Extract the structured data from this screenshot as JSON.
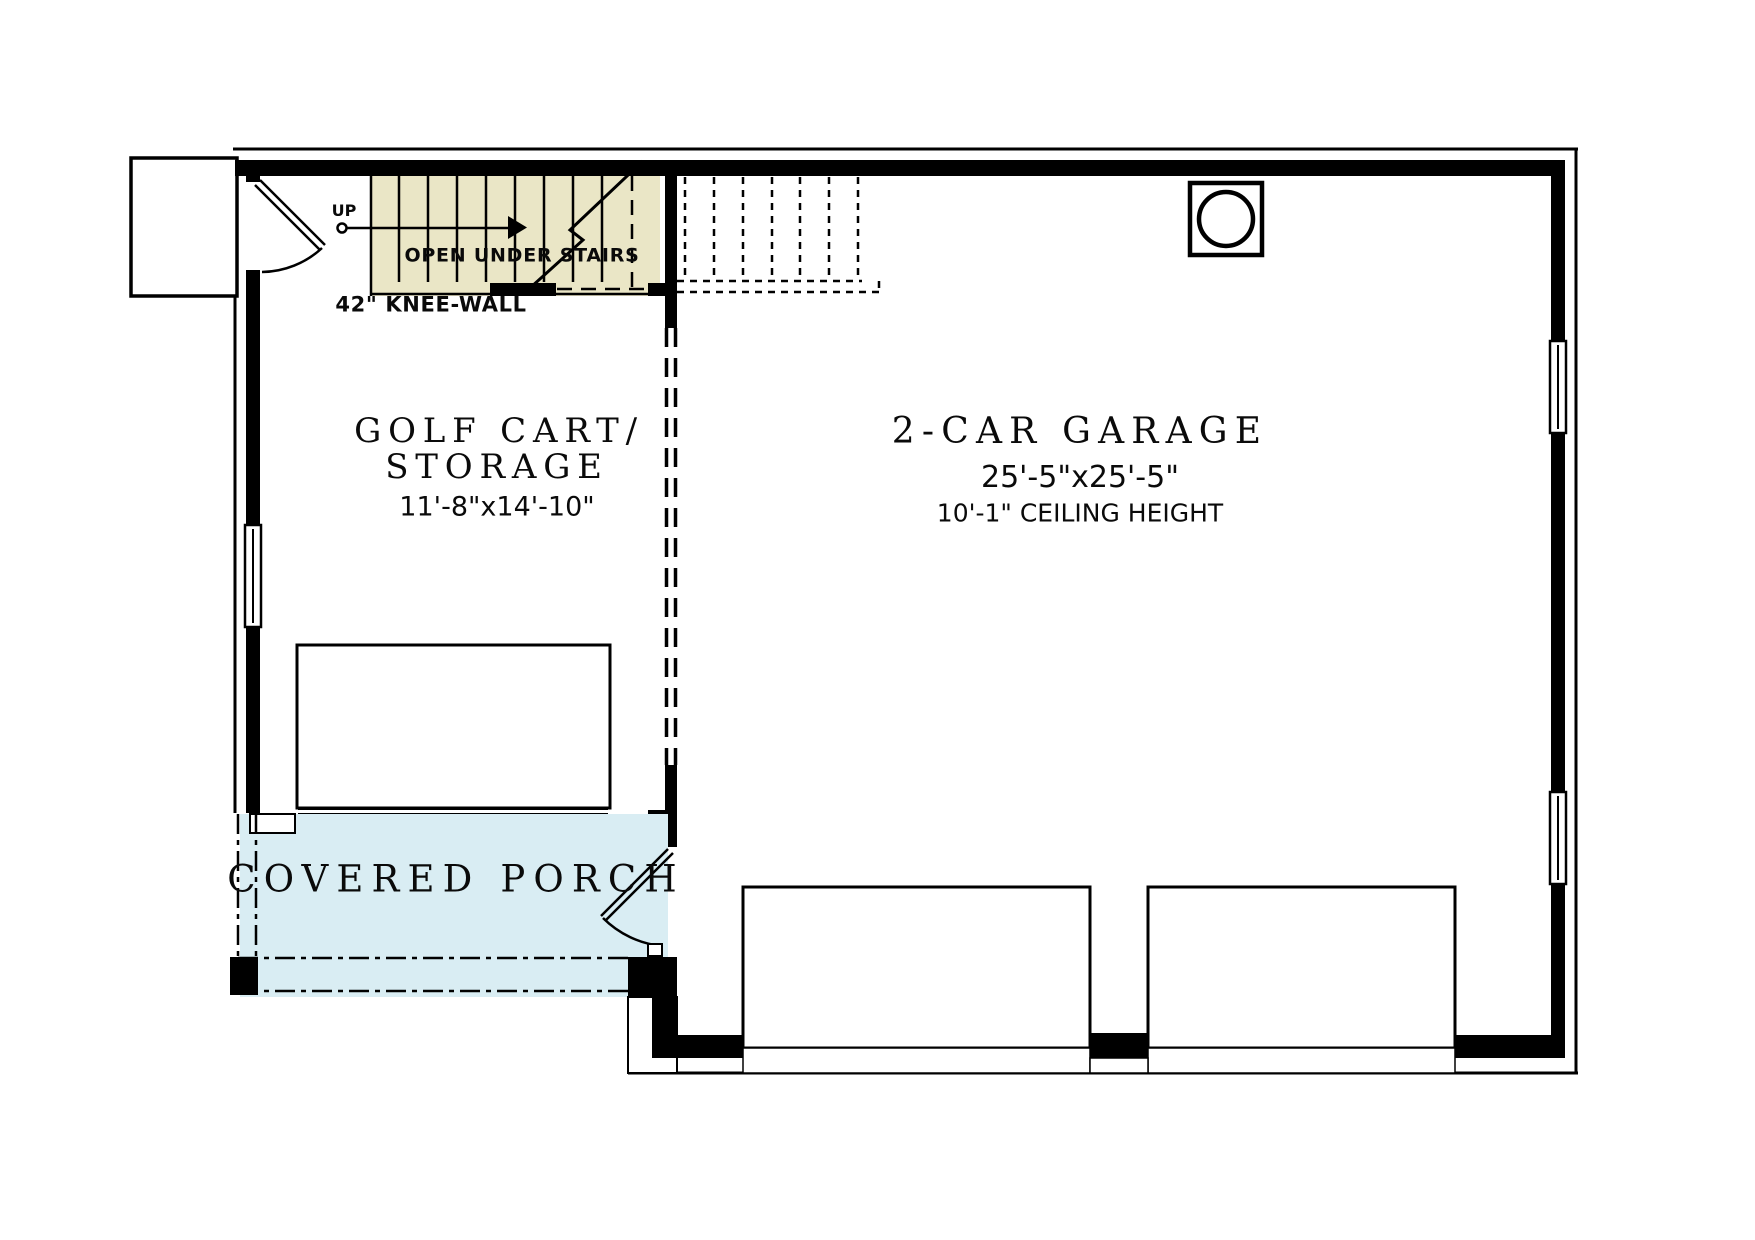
{
  "title": "Garage Floor Plan",
  "rooms": {
    "storage": {
      "title": "GOLF CART/",
      "title2": "STORAGE",
      "size": "11'-8\"x14'-10\""
    },
    "garage": {
      "title": "2-CAR GARAGE",
      "size": "25'-5\"x25'-5\"",
      "ceiling": "10'-1\" CEILING HEIGHT"
    },
    "porch": {
      "title": "COVERED PORCH"
    }
  },
  "annotations": {
    "up": "UP",
    "open_under_stairs": "OPEN UNDER STAIRS",
    "knee_wall": "42\" KNEE-WALL"
  },
  "colors": {
    "wall": "#000000",
    "stair_fill": "#EAE6C6",
    "porch_fill": "#D9EDF3",
    "ink": "#0a0a0a"
  }
}
